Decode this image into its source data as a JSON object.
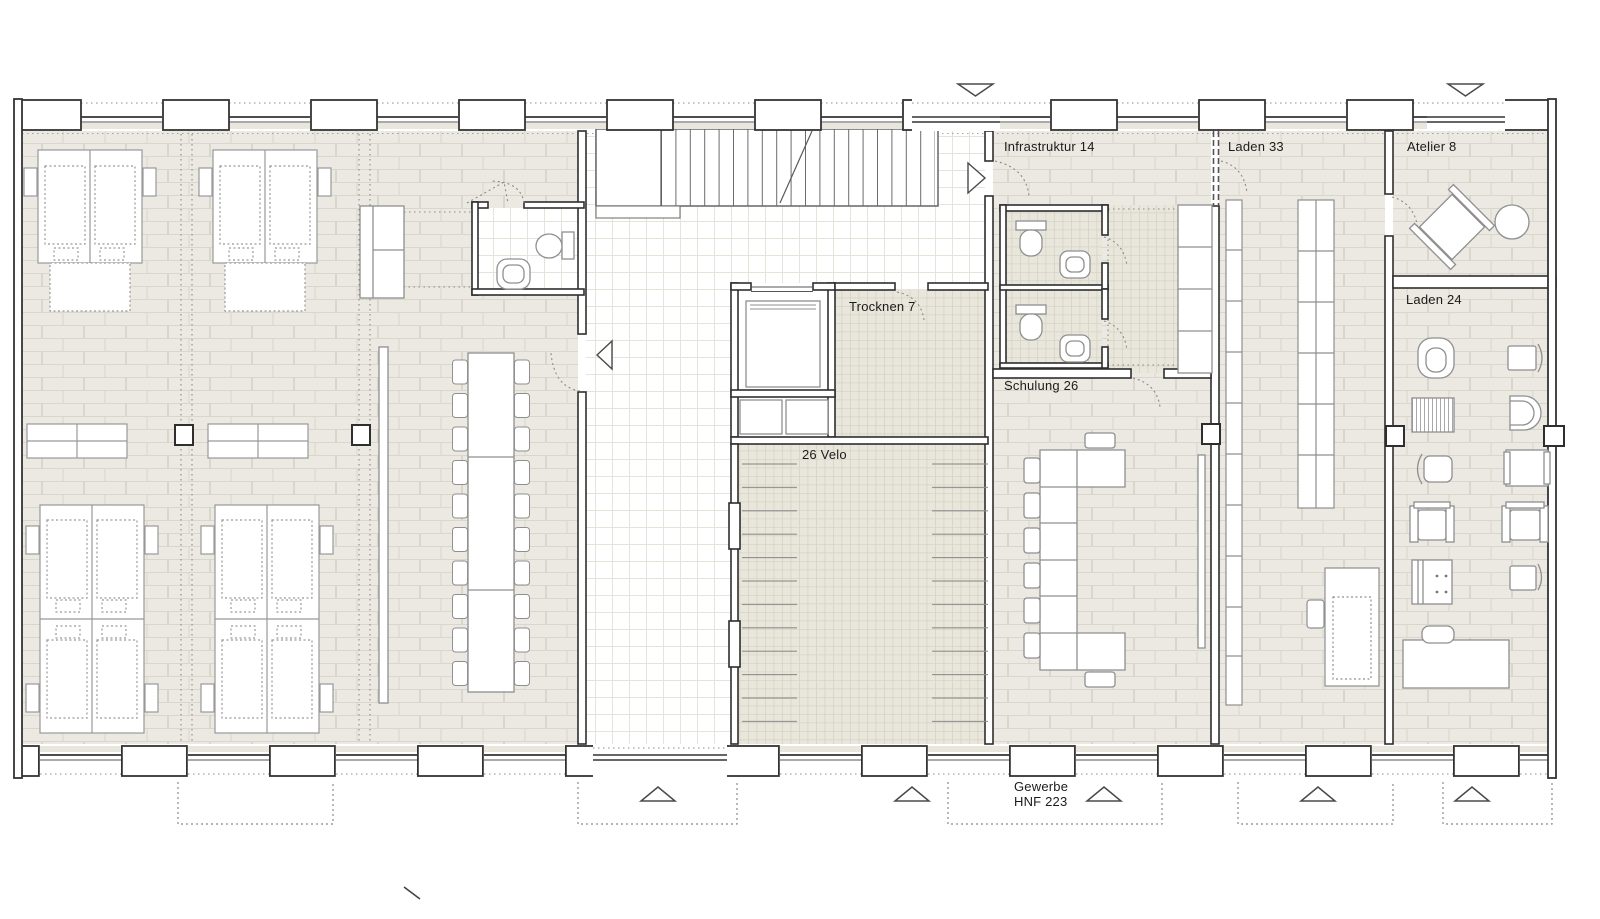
{
  "plan": {
    "type": "architectural floor plan, ground floor",
    "labels": {
      "infrastruktur": "Infrastruktur 14",
      "laden33": "Laden 33",
      "atelier": "Atelier 8",
      "laden24": "Laden 24",
      "trocknen": "Trocknen 7",
      "schulung": "Schulung 26",
      "velo": "26 Velo",
      "gewerbe_line1": "Gewerbe",
      "gewerbe_line2": "HNF 223"
    },
    "colors": {
      "paper": "#ffffff",
      "tile_fill": "#ebe9e1",
      "tile_joint": "#d9d6cb",
      "fine_grid_fill": "#ffffff",
      "fine_grid_line": "#e5e3da",
      "dense_grid_fill": "#e9e6db",
      "dense_grid_line": "#d7d3c6",
      "wall_line": "#2e2e2e",
      "furniture_line": "#8f8f8f",
      "dotted_line": "#8a8a8a"
    },
    "icons": {
      "entrance_marker": "hollow triangle",
      "door_direction_marker": "hollow triangle",
      "door_swing": "dotted arc"
    }
  }
}
